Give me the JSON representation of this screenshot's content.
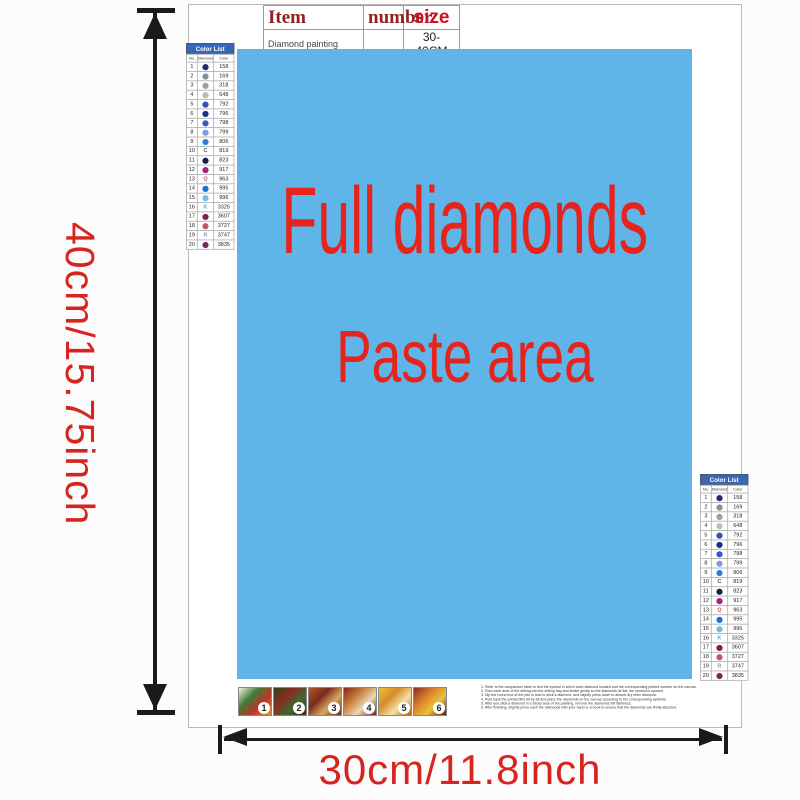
{
  "item_table": {
    "headers": [
      "Item",
      "number",
      "size"
    ],
    "row": {
      "item": "Diamond painting",
      "number": "",
      "size": "30-40CM"
    }
  },
  "paste_area": {
    "line1": "Full diamonds",
    "line2": "Paste area"
  },
  "dimensions": {
    "height_label": "40cm/15.75inch",
    "width_label": "30cm/11.8inch"
  },
  "color_list": {
    "title": "Color List",
    "columns": [
      "No.",
      "Diamond",
      "Color"
    ],
    "rows": [
      {
        "no": "1",
        "shape": "circle",
        "letter": "",
        "color_hex": "#1f2d74",
        "code": "158"
      },
      {
        "no": "2",
        "shape": "circle",
        "letter": "",
        "color_hex": "#8a8f94",
        "code": "169"
      },
      {
        "no": "3",
        "shape": "circle",
        "letter": "",
        "color_hex": "#9aa0a6",
        "code": "318"
      },
      {
        "no": "4",
        "shape": "circle",
        "letter": "",
        "color_hex": "#b9bdb2",
        "code": "648"
      },
      {
        "no": "5",
        "shape": "circle",
        "letter": "",
        "color_hex": "#3752b5",
        "code": "792"
      },
      {
        "no": "6",
        "shape": "circle",
        "letter": "",
        "color_hex": "#1b2f91",
        "code": "796"
      },
      {
        "no": "7",
        "shape": "circle",
        "letter": "",
        "color_hex": "#2e5bc7",
        "code": "798"
      },
      {
        "no": "8",
        "shape": "circle",
        "letter": "",
        "color_hex": "#7d9ede",
        "code": "799"
      },
      {
        "no": "9",
        "shape": "circle",
        "letter": "",
        "color_hex": "#2f7fd1",
        "code": "806"
      },
      {
        "no": "10",
        "shape": "letter",
        "letter": "C",
        "color_hex": "#555555",
        "code": "819"
      },
      {
        "no": "11",
        "shape": "circle",
        "letter": "",
        "color_hex": "#16204f",
        "code": "823"
      },
      {
        "no": "12",
        "shape": "circle",
        "letter": "",
        "color_hex": "#b01e7e",
        "code": "917"
      },
      {
        "no": "13",
        "shape": "letter",
        "letter": "Q",
        "color_hex": "#c2566e",
        "code": "963"
      },
      {
        "no": "14",
        "shape": "circle",
        "letter": "",
        "color_hex": "#1d6fd1",
        "code": "995"
      },
      {
        "no": "15",
        "shape": "circle",
        "letter": "",
        "color_hex": "#66c2ec",
        "code": "996"
      },
      {
        "no": "16",
        "shape": "letter",
        "letter": "K",
        "color_hex": "#6f9bd4",
        "code": "3325"
      },
      {
        "no": "17",
        "shape": "circle",
        "letter": "",
        "color_hex": "#7e1f4e",
        "code": "3607"
      },
      {
        "no": "18",
        "shape": "circle",
        "letter": "",
        "color_hex": "#c25570",
        "code": "3727"
      },
      {
        "no": "19",
        "shape": "letter",
        "letter": "R",
        "color_hex": "#8c96cc",
        "code": "3747"
      },
      {
        "no": "20",
        "shape": "circle",
        "letter": "",
        "color_hex": "#77285e",
        "code": "3835"
      }
    ]
  },
  "steps": [
    {
      "label": "1",
      "colors": [
        "#f5f2ea",
        "#3e7a33",
        "#c03427",
        "#d98f3a"
      ]
    },
    {
      "label": "2",
      "colors": [
        "#27441c",
        "#8a2b22",
        "#3c6b2d",
        "#5f1f1f"
      ]
    },
    {
      "label": "3",
      "colors": [
        "#b05a24",
        "#7a2a1e",
        "#d9a85f",
        "#5f3317"
      ]
    },
    {
      "label": "4",
      "colors": [
        "#8a2420",
        "#c77f3a",
        "#e8d9b5",
        "#6b2a1c"
      ]
    },
    {
      "label": "5",
      "colors": [
        "#e8c23a",
        "#d98a2b",
        "#f2e0a0",
        "#b5651d"
      ]
    },
    {
      "label": "6",
      "colors": [
        "#8a2a1e",
        "#d9822b",
        "#e8c23a",
        "#5f1f14"
      ]
    }
  ],
  "instructions": {
    "lines": [
      "1. Refer to the comparison table to find the symbol in which each diamond located and the corresponding printed number on the canvas.",
      "2. Pour each area of the drilling into the drilling tray and shake gently so the diamonds lie flat, the symbol is upward.",
      "3. Dip the round end of the pen in wax to stick a diamond, and slightly press down to absorb dry resin diamond.",
      "4. Peel back the printed film bit by bit and place the diamonds on the canvas according to the corresponding symbols.",
      "5. After you stick a diamond in a sticky area of the painting, remove the diamonds left faintness.",
      "6. After finishing, slightly press each the diamonds with your hand or a book to ensure that the diamonds are firmly attached."
    ]
  },
  "colors": {
    "paste_area_blue": "#5fb5e8",
    "paste_text_red": "#e8231c",
    "dimension_red": "#d6251f",
    "table_header_red": "#8f2222",
    "size_red": "#cc1020",
    "colorlist_header_bg": "#3566b8",
    "arrow_black": "#1a1a1a"
  }
}
